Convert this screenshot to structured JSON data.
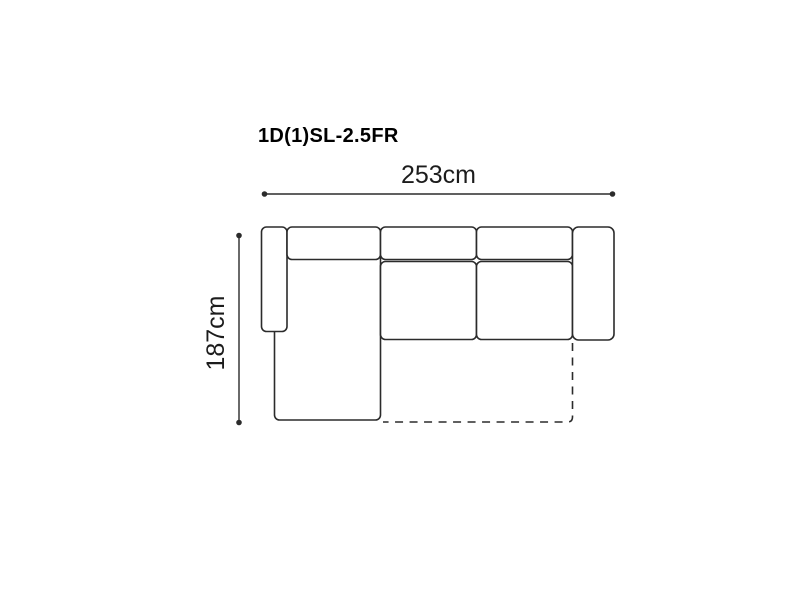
{
  "diagram": {
    "title": "1D(1)SL-2.5FR",
    "dimensions": {
      "width_label": "253cm",
      "width_cm": 253,
      "depth_label": "187cm",
      "depth_cm": 187
    },
    "style": {
      "background": "#ffffff",
      "line_color": "#2b2b2b",
      "text_color": "#1c1c1c",
      "title_color": "#000000"
    },
    "parts": [
      "left-armrest",
      "chaise-seat",
      "chaise-backrest",
      "center-backrest",
      "right-backrest",
      "center-seat",
      "right-seat",
      "right-armrest",
      "fold-out-section-dashed-outline"
    ],
    "view": "top-view sofa dimension diagram"
  }
}
